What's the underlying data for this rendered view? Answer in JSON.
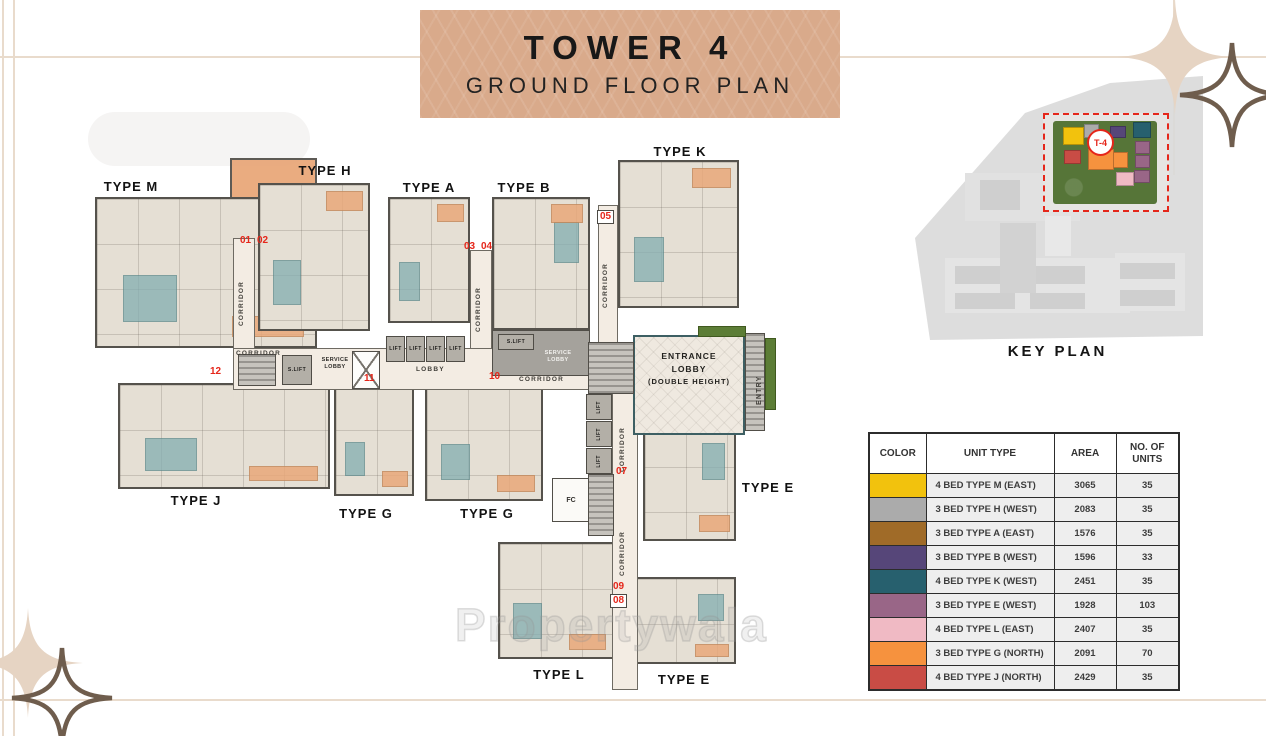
{
  "banner": {
    "title": "TOWER 4",
    "subtitle": "GROUND FLOOR PLAN"
  },
  "plan": {
    "labels": {
      "type_m": "TYPE M",
      "type_h": "TYPE H",
      "type_a": "TYPE A",
      "type_b": "TYPE B",
      "type_k": "TYPE K",
      "type_j": "TYPE J",
      "type_g_left": "TYPE G",
      "type_g_right": "TYPE G",
      "type_e_right": "TYPE E",
      "type_l": "TYPE L",
      "type_e_bottom": "TYPE E",
      "corridor": "CORRIDOR",
      "lobby": "LOBBY",
      "lift": "LIFT",
      "s_lift": "S.LIFT",
      "service_lobby": "SERVICE LOBBY",
      "entrance_line1": "ENTRANCE",
      "entrance_line2": "LOBBY",
      "entrance_line3": "(DOUBLE HEIGHT)",
      "entry": "ENTRY",
      "fc": "FC"
    },
    "numbers": {
      "n01": "01",
      "n02": "02",
      "n03": "03",
      "n04": "04",
      "n05": "05",
      "n07": "07",
      "n08": "08",
      "n09": "09",
      "n10": "10",
      "n11": "11",
      "n12": "12"
    }
  },
  "key_plan": {
    "title": "KEY PLAN",
    "marker": "T-4"
  },
  "legend": {
    "headers": [
      "COLOR",
      "UNIT TYPE",
      "AREA",
      "NO. OF UNITS"
    ],
    "rows": [
      {
        "color": "#F2C20D",
        "unit_type": "4 BED TYPE M (EAST)",
        "area": "3065",
        "units": "35"
      },
      {
        "color": "#ABABAB",
        "unit_type": "3 BED TYPE H (WEST)",
        "area": "2083",
        "units": "35"
      },
      {
        "color": "#A06B28",
        "unit_type": "3 BED TYPE A (EAST)",
        "area": "1576",
        "units": "35"
      },
      {
        "color": "#564679",
        "unit_type": "3 BED TYPE B (WEST)",
        "area": "1596",
        "units": "33"
      },
      {
        "color": "#27606E",
        "unit_type": "4 BED TYPE K (WEST)",
        "area": "2451",
        "units": "35"
      },
      {
        "color": "#996687",
        "unit_type": "3 BED TYPE E (WEST)",
        "area": "1928",
        "units": "103"
      },
      {
        "color": "#F0BAC4",
        "unit_type": "4 BED TYPE L (EAST)",
        "area": "2407",
        "units": "35"
      },
      {
        "color": "#F6923E",
        "unit_type": "3 BED TYPE G (NORTH)",
        "area": "2091",
        "units": "70"
      },
      {
        "color": "#C94C45",
        "unit_type": "4 BED TYPE J (NORTH)",
        "area": "2429",
        "units": "35"
      }
    ]
  },
  "watermark": "Propertywala"
}
